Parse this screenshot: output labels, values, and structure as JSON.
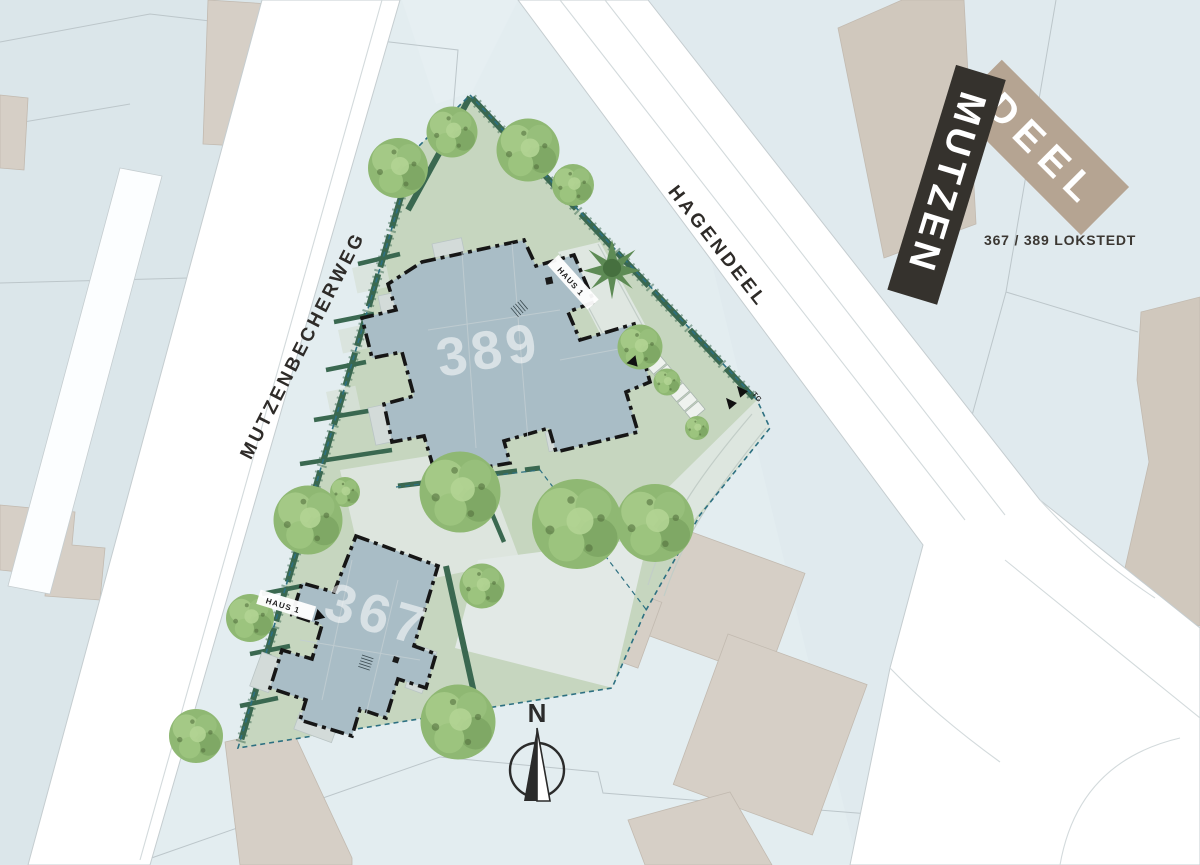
{
  "logo": {
    "name_line1": "MUTZEN",
    "name_line2": "DEEL",
    "address": "367 / 389 LOKSTEDT"
  },
  "streets": {
    "west": "MUTZENBECHERWEG",
    "northeast": "HAGENDEEL"
  },
  "buildings": {
    "north": {
      "number": "389",
      "entrance_label": "HAUS 1"
    },
    "south": {
      "number": "367",
      "entrance_label": "HAUS 1"
    }
  },
  "annotations": {
    "underground_garage": "TG",
    "compass_north": "N"
  },
  "colors": {
    "background": "#e3edf0",
    "street": "#ffffff",
    "site_lawn": "#c6d6bf",
    "path_pale": "#e0e8e3",
    "hedge_green": "#3a6850",
    "boundary_teal": "#2d7081",
    "building_fill": "#a9bdc6",
    "building_outline": "#161616",
    "neighbor_building": "#d6cfc6",
    "brand_dark": "#35322d",
    "brand_beige": "#b5a492"
  }
}
